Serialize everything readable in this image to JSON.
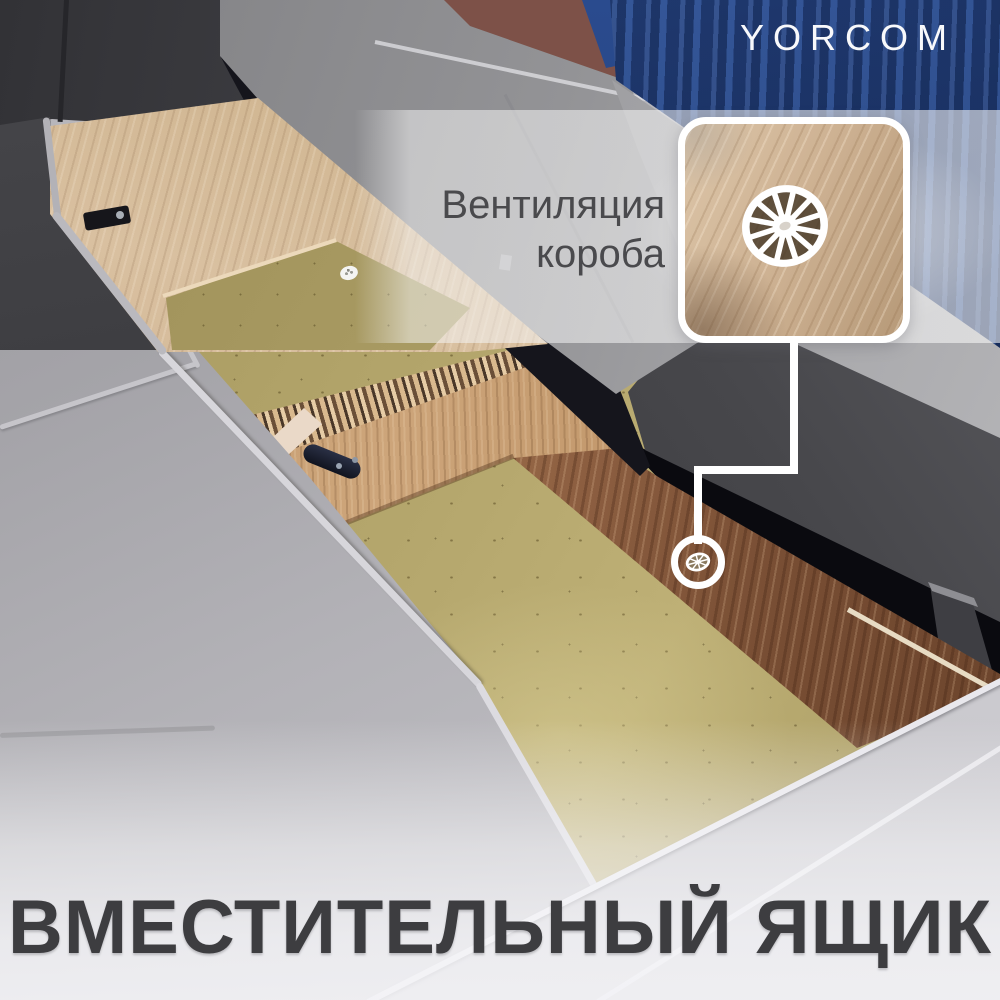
{
  "brand": {
    "logo": "YORCOM",
    "logo_color": "#f8f9fb"
  },
  "annotation": {
    "line1": "Вентиляция",
    "line2": "короба",
    "text_color": "#4a4a4d"
  },
  "caption": {
    "title": "ВМЕСТИТЕЛЬНЫЙ ЯЩИК",
    "text_color": "#3d3d40"
  },
  "callout": {
    "target": "ventilation-grommet",
    "line_color": "#ffffff",
    "shape": "rounded-square-inset-with-circle-pointer"
  },
  "scene": {
    "subject": "sofa-with-open-storage-boxes",
    "details": [
      "oak-storage-box-walls",
      "mdf-box-bottom",
      "white-plastic-vent-wheel",
      "black-hinge",
      "fabric-strap-handle",
      "gray-velvet-cushions",
      "blue-corrugated-wall",
      "brick-wall"
    ]
  },
  "palette": {
    "wall_blue": "#1e3a74",
    "brick": "#7d5148",
    "sofa_gray": "#a5a4a9",
    "cushion_front": "#d8d7dc",
    "wood_oak": "#cdb192",
    "wood_walnut": "#774d33",
    "mdf": "#b5a76d",
    "shadow_black": "#0a0a0f",
    "panel_dark": "#3e3e43",
    "vent_white": "#ffffff"
  }
}
